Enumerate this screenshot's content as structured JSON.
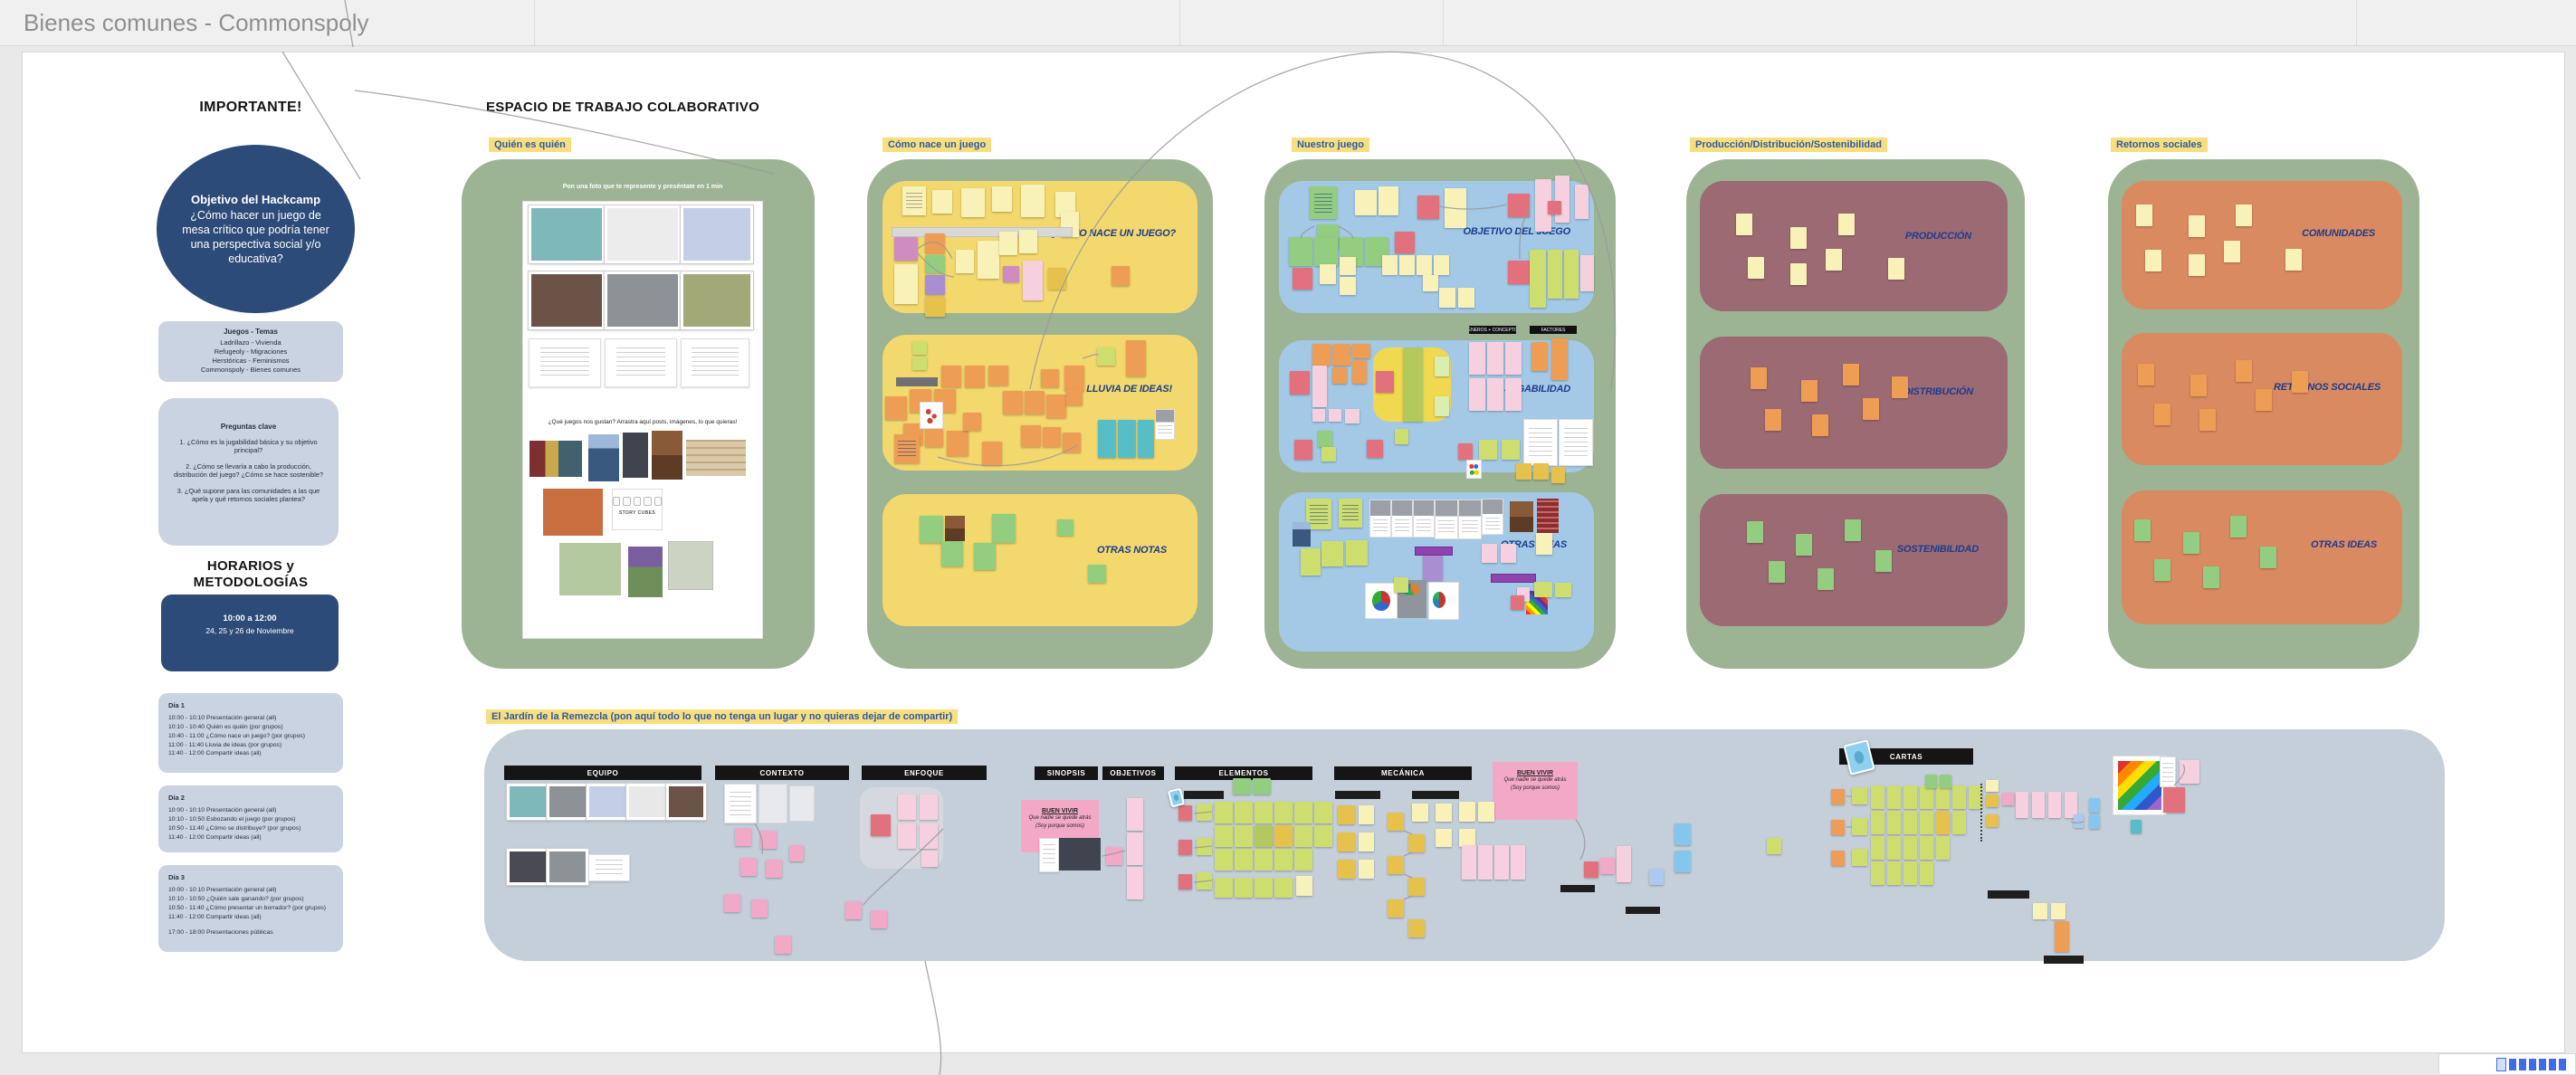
{
  "window": {
    "title": "Bienes comunes - Commonspoly"
  },
  "left_panel": {
    "importante_heading": "IMPORTANTE!",
    "objetivo": {
      "title": "Objetivo del Hackcamp",
      "body": "¿Cómo hacer un juego de mesa crítico que podría tener una perspectiva social y/o educativa?"
    },
    "juegos_temas": {
      "title": "Juegos - Temas",
      "items": [
        "Ladrillazo - Vivienda",
        "Refugeoly - Migraciones",
        "Herstóricas - Feminismos",
        "Commonspoly - Bienes comunes"
      ]
    },
    "preguntas_clave": {
      "title": "Preguntas clave",
      "items": [
        "1. ¿Cómo es la jugabilidad básica y su objetivo principal?",
        "2. ¿Cómo se llevaría a cabo la producción, distribución del juego? ¿Cómo se hace sostenible?",
        "3. ¿Qué supone para las comunidades a las que apela y qué retornos sociales plantea?"
      ]
    },
    "horarios_heading": "HORARIOS y METODOLOGÍAS",
    "horario_destacado": {
      "hora": "10:00 a 12:00",
      "fechas": "24, 25 y 26 de Noviembre"
    },
    "dias": [
      {
        "title": "Día 1",
        "lines": [
          "10:00 - 10:10 Presentación general (all)",
          "10:10 - 10:40 Quién es quién (por grupos)",
          "10:40 - 11:00 ¿Cómo nace un juego? (por grupos)",
          "11:00 - 11:40 Lluvia de ideas (por grupos)",
          "11:40 - 12:00 Compartir ideas (all)"
        ]
      },
      {
        "title": "Día 2",
        "lines": [
          "10:00 - 10:10 Presentación general (all)",
          "10:10 - 10:50 Esbozando el juego (por grupos)",
          "10:50 - 11:40 ¿Cómo se distribuye? (por grupos)",
          "11:40 - 12:00 Compartir ideas (all)"
        ]
      },
      {
        "title": "Día 3",
        "lines": [
          "10:00 - 10:10 Presentación general (all)",
          "10:10 - 10:50 ¿Quién sale ganando? (por grupos)",
          "10:50 - 11:40 ¿Cómo presentar un borrador? (por grupos)",
          "11:40 - 12:00 Compartir ideas (all)",
          "",
          "17:00 - 18:00 Presentaciones públicas"
        ]
      }
    ]
  },
  "workspace": {
    "title": "ESPACIO DE TRABAJO COLABORATIVO",
    "frames": [
      {
        "label": "Quién es quién",
        "instruction": "Pon una foto que te represente y preséntate en 1 min",
        "prompt": "¿Qué juegos nos gustan? Arrastra aquí posts, imágenes, lo que quieras!",
        "caption": "STORY CUBES"
      },
      {
        "label": "Cómo nace un juego",
        "boxes": [
          "¿CÓMO NACE UN JUEGO?",
          "LLUVIA DE IDEAS!",
          "OTRAS NOTAS"
        ]
      },
      {
        "label": "Nuestro juego",
        "boxes": [
          "OBJETIVO DEL JUEGO",
          "JUGABILIDAD",
          "OTRAS IDEAS"
        ],
        "tags": [
          "GÉNEROS + CONCEPTOS",
          "FACTORES"
        ]
      },
      {
        "label": "Producción/Distribución/Sostenibilidad",
        "boxes": [
          "PRODUCCIÓN",
          "DISTRIBUCIÓN",
          "SOSTENIBILIDAD"
        ]
      },
      {
        "label": "Retornos sociales",
        "boxes": [
          "COMUNIDADES",
          "RETORNOS SOCIALES",
          "OTRAS IDEAS"
        ]
      }
    ],
    "garden": {
      "label": "El Jardín de la Remezcla (pon aquí todo lo que no tenga un lugar y no quieras dejar de compartir)",
      "bars": [
        "EQUIPO",
        "CONTEXTO",
        "ENFOQUE",
        "SINOPSIS",
        "OBJETIVOS",
        "ELEMENTOS",
        "MECÁNICA",
        "CARTAS"
      ],
      "buen_vivir": {
        "title": "BUEN VIVIR",
        "line1": "Que nadie se quede atrás",
        "line2": "(Soy porque somos)"
      }
    }
  },
  "colors": {
    "accent_blue": "#2d4b78",
    "label_bg": "#f7df7e",
    "label_text": "#2e59aa",
    "frame_green": "#9cb394",
    "box_yellow": "#f2d86d",
    "box_blue": "#a3c9e6",
    "box_mauve": "#9c6a73",
    "box_salmon": "#da8a61",
    "garden_bg": "#c5cfda"
  }
}
